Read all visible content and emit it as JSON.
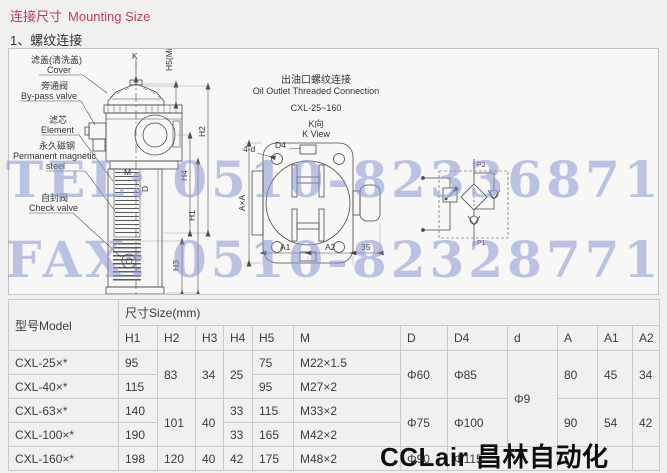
{
  "page": {
    "title_zh": "连接尺寸",
    "title_en": "Mounting Size",
    "section": "1、螺纹连接",
    "title_color": "#c13b56"
  },
  "watermarks": {
    "tel": "TEL: 0510-82336871",
    "fax": "FAX: 0510-82328771",
    "brand": "CCLair 昌林自动化",
    "color": "#8a96d6"
  },
  "drawing": {
    "labels": {
      "cover_zh": "滤盖(清洗盖)",
      "cover_en": "Cover",
      "bypass_zh": "旁通阀",
      "bypass_en": "By-pass valve",
      "element_zh": "滤芯",
      "element_en": "Element",
      "magnet_zh": "永久磁钢",
      "magnet_en1": "Permanent magnetic",
      "magnet_en2": "steel",
      "check_zh": "自封阀",
      "check_en": "Check valve"
    },
    "dims": {
      "k": "K",
      "h5": "H5(Min.)",
      "h2": "H2",
      "h4": "H4",
      "h1": "H1",
      "h3": "H3",
      "m": "M",
      "d": "D",
      "four_d": "4-d",
      "d4": "D4",
      "axa": "A×A",
      "a1": "A1",
      "a2": "A2",
      "n35": "35"
    },
    "outlet": {
      "title_zh": "出油口螺纹连接",
      "title_en": "Oil Outlet Threaded Connection",
      "range": "CXL-25~160",
      "view_zh": "K向",
      "view_en": "K View"
    },
    "schematic": {
      "p2": "P2",
      "p1": "P1"
    }
  },
  "table": {
    "model_header": "型号Model",
    "size_header": "尺寸Size(mm)",
    "columns": [
      "H1",
      "H2",
      "H3",
      "H4",
      "H5",
      "M",
      "D",
      "D4",
      "d",
      "A",
      "A1",
      "A2"
    ],
    "rows": [
      {
        "model": "CXL-25×*",
        "cells": [
          {
            "v": "95"
          },
          {
            "v": "83",
            "rs": 2
          },
          {
            "v": "34",
            "rs": 2
          },
          {
            "v": "25",
            "rs": 2
          },
          {
            "v": "75"
          },
          {
            "v": "M22×1.5"
          },
          {
            "v": "Φ60",
            "rs": 2
          },
          {
            "v": "Φ85",
            "rs": 2
          },
          {
            "v": "Φ9",
            "rs": 4
          },
          {
            "v": "80",
            "rs": 2
          },
          {
            "v": "45",
            "rs": 2
          },
          {
            "v": "34",
            "rs": 2
          }
        ]
      },
      {
        "model": "CXL-40×*",
        "cells": [
          {
            "v": "115"
          },
          {
            "v": "95"
          },
          {
            "v": "M27×2"
          }
        ]
      },
      {
        "model": "CXL-63×*",
        "cells": [
          {
            "v": "140"
          },
          {
            "v": "101",
            "rs": 2
          },
          {
            "v": "40",
            "rs": 2
          },
          {
            "v": "33"
          },
          {
            "v": "115"
          },
          {
            "v": "M33×2"
          },
          {
            "v": "Φ75",
            "rs": 2
          },
          {
            "v": "Φ100",
            "rs": 2
          },
          {
            "v": "90",
            "rs": 2
          },
          {
            "v": "54",
            "rs": 2
          },
          {
            "v": "42",
            "rs": 2
          }
        ]
      },
      {
        "model": "CXL-100×*",
        "cells": [
          {
            "v": "190"
          },
          {
            "v": "33"
          },
          {
            "v": "165"
          },
          {
            "v": "M42×2"
          }
        ]
      },
      {
        "model": "CXL-160×*",
        "cells": [
          {
            "v": "198"
          },
          {
            "v": "120"
          },
          {
            "v": "40"
          },
          {
            "v": "42"
          },
          {
            "v": "175"
          },
          {
            "v": "M48×2"
          },
          {
            "v": "Φ90"
          },
          {
            "v": "Φ115"
          },
          {
            "v": ""
          },
          {
            "v": ""
          },
          {
            "v": ""
          },
          {
            "v": ""
          }
        ]
      }
    ]
  }
}
